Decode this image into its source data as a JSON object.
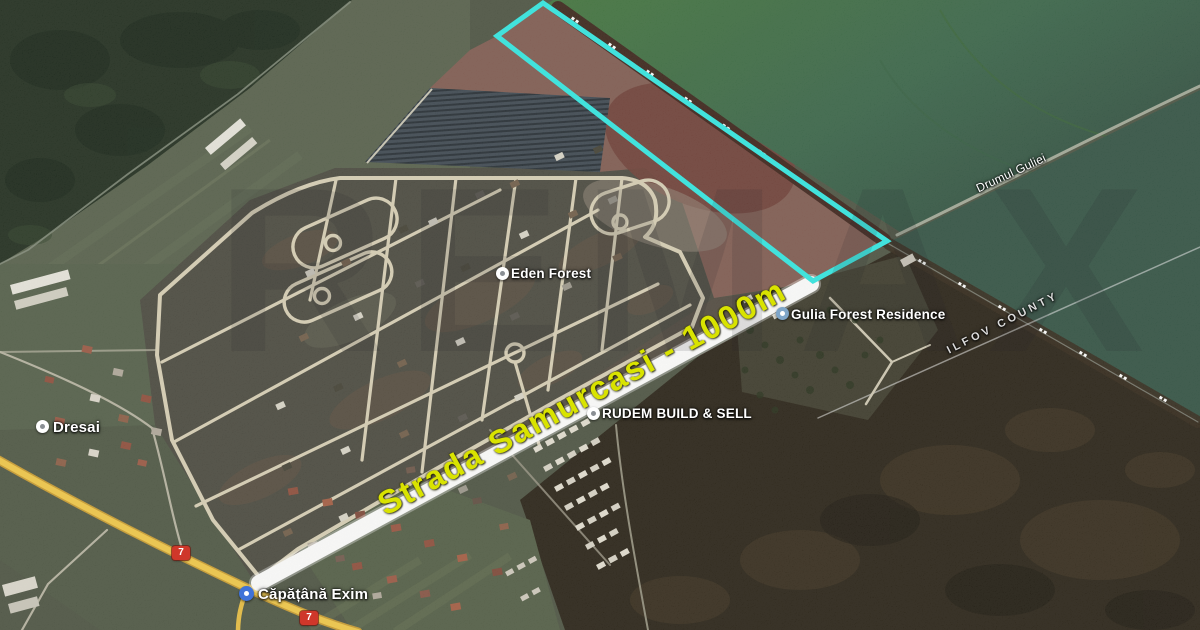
{
  "map": {
    "labels": {
      "eden": "Eden Forest",
      "gulia": "Gulia Forest Residence",
      "rudem": "RUDEM BUILD & SELL",
      "dresai": "Dresai",
      "capatana": "Căpățână Exim",
      "road": "Drumul Guliei",
      "county": "ILFOV COUNTY"
    },
    "annotation": {
      "street_label": "Strada Samurcasi - 1000m",
      "measurement": "1000m",
      "street_name": "Strada Samurcasi"
    },
    "badges": {
      "dn7_north": "7",
      "dn7_south": "7"
    },
    "watermark": "REMAX",
    "colors": {
      "outline": "#2ee9e4",
      "highlight": "#ffffff",
      "streetlabel": "#d9e300",
      "highway": "#f2c844"
    }
  }
}
